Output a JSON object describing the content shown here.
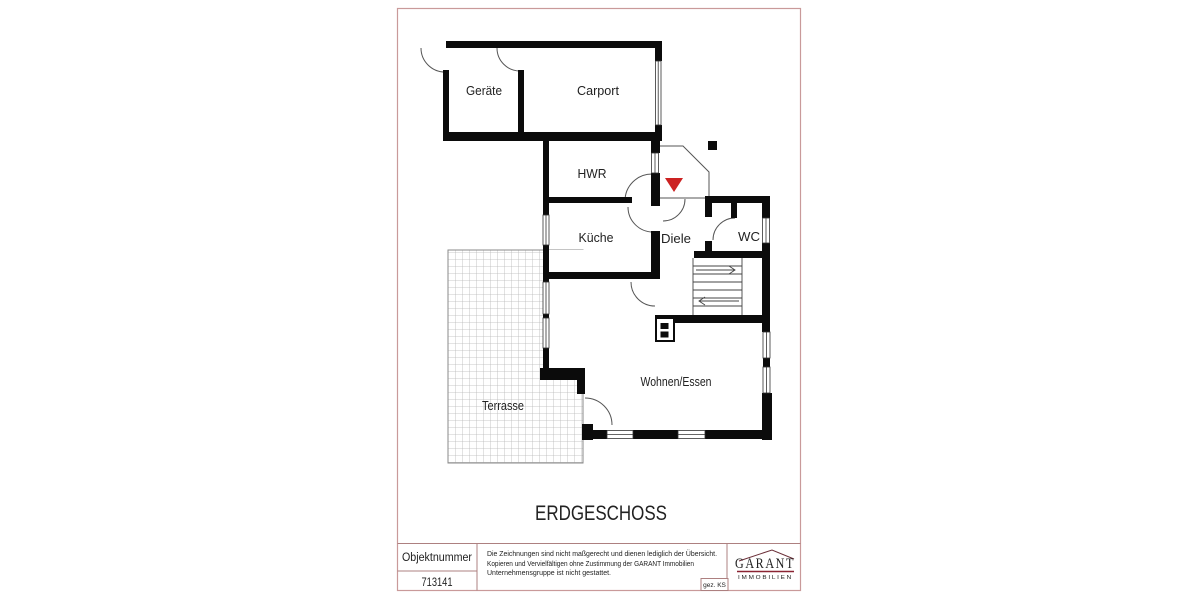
{
  "floor_plan": {
    "title": "ERDGESCHOSS",
    "rooms": {
      "geraete": "Geräte",
      "carport": "Carport",
      "hwr": "HWR",
      "kueche": "Küche",
      "diele": "Diele",
      "wc": "WC",
      "wohnen_essen": "Wohnen/Essen",
      "terrasse": "Terrasse"
    },
    "entrance_marker_color": "#cc2222"
  },
  "title_block": {
    "object_number_label": "Objektnummer",
    "object_number": "713141",
    "disclaimer_line1": "Die Zeichnungen sind nicht maßgerecht und dienen lediglich der Übersicht.",
    "disclaimer_line2": "Kopieren und Vervielfältigen ohne Zustimmung der GARANT Immobilien",
    "disclaimer_line3": "Unternehmensgruppe ist nicht gestattet.",
    "signed_by": "gez. KS",
    "logo_name": "GARANT",
    "logo_subtitle": "IMMOBILIEN",
    "logo_color": "#8b2433"
  },
  "colors": {
    "page_border": "#c99a9a",
    "table_line": "#ad8080",
    "wall": "#0b0b0b"
  }
}
